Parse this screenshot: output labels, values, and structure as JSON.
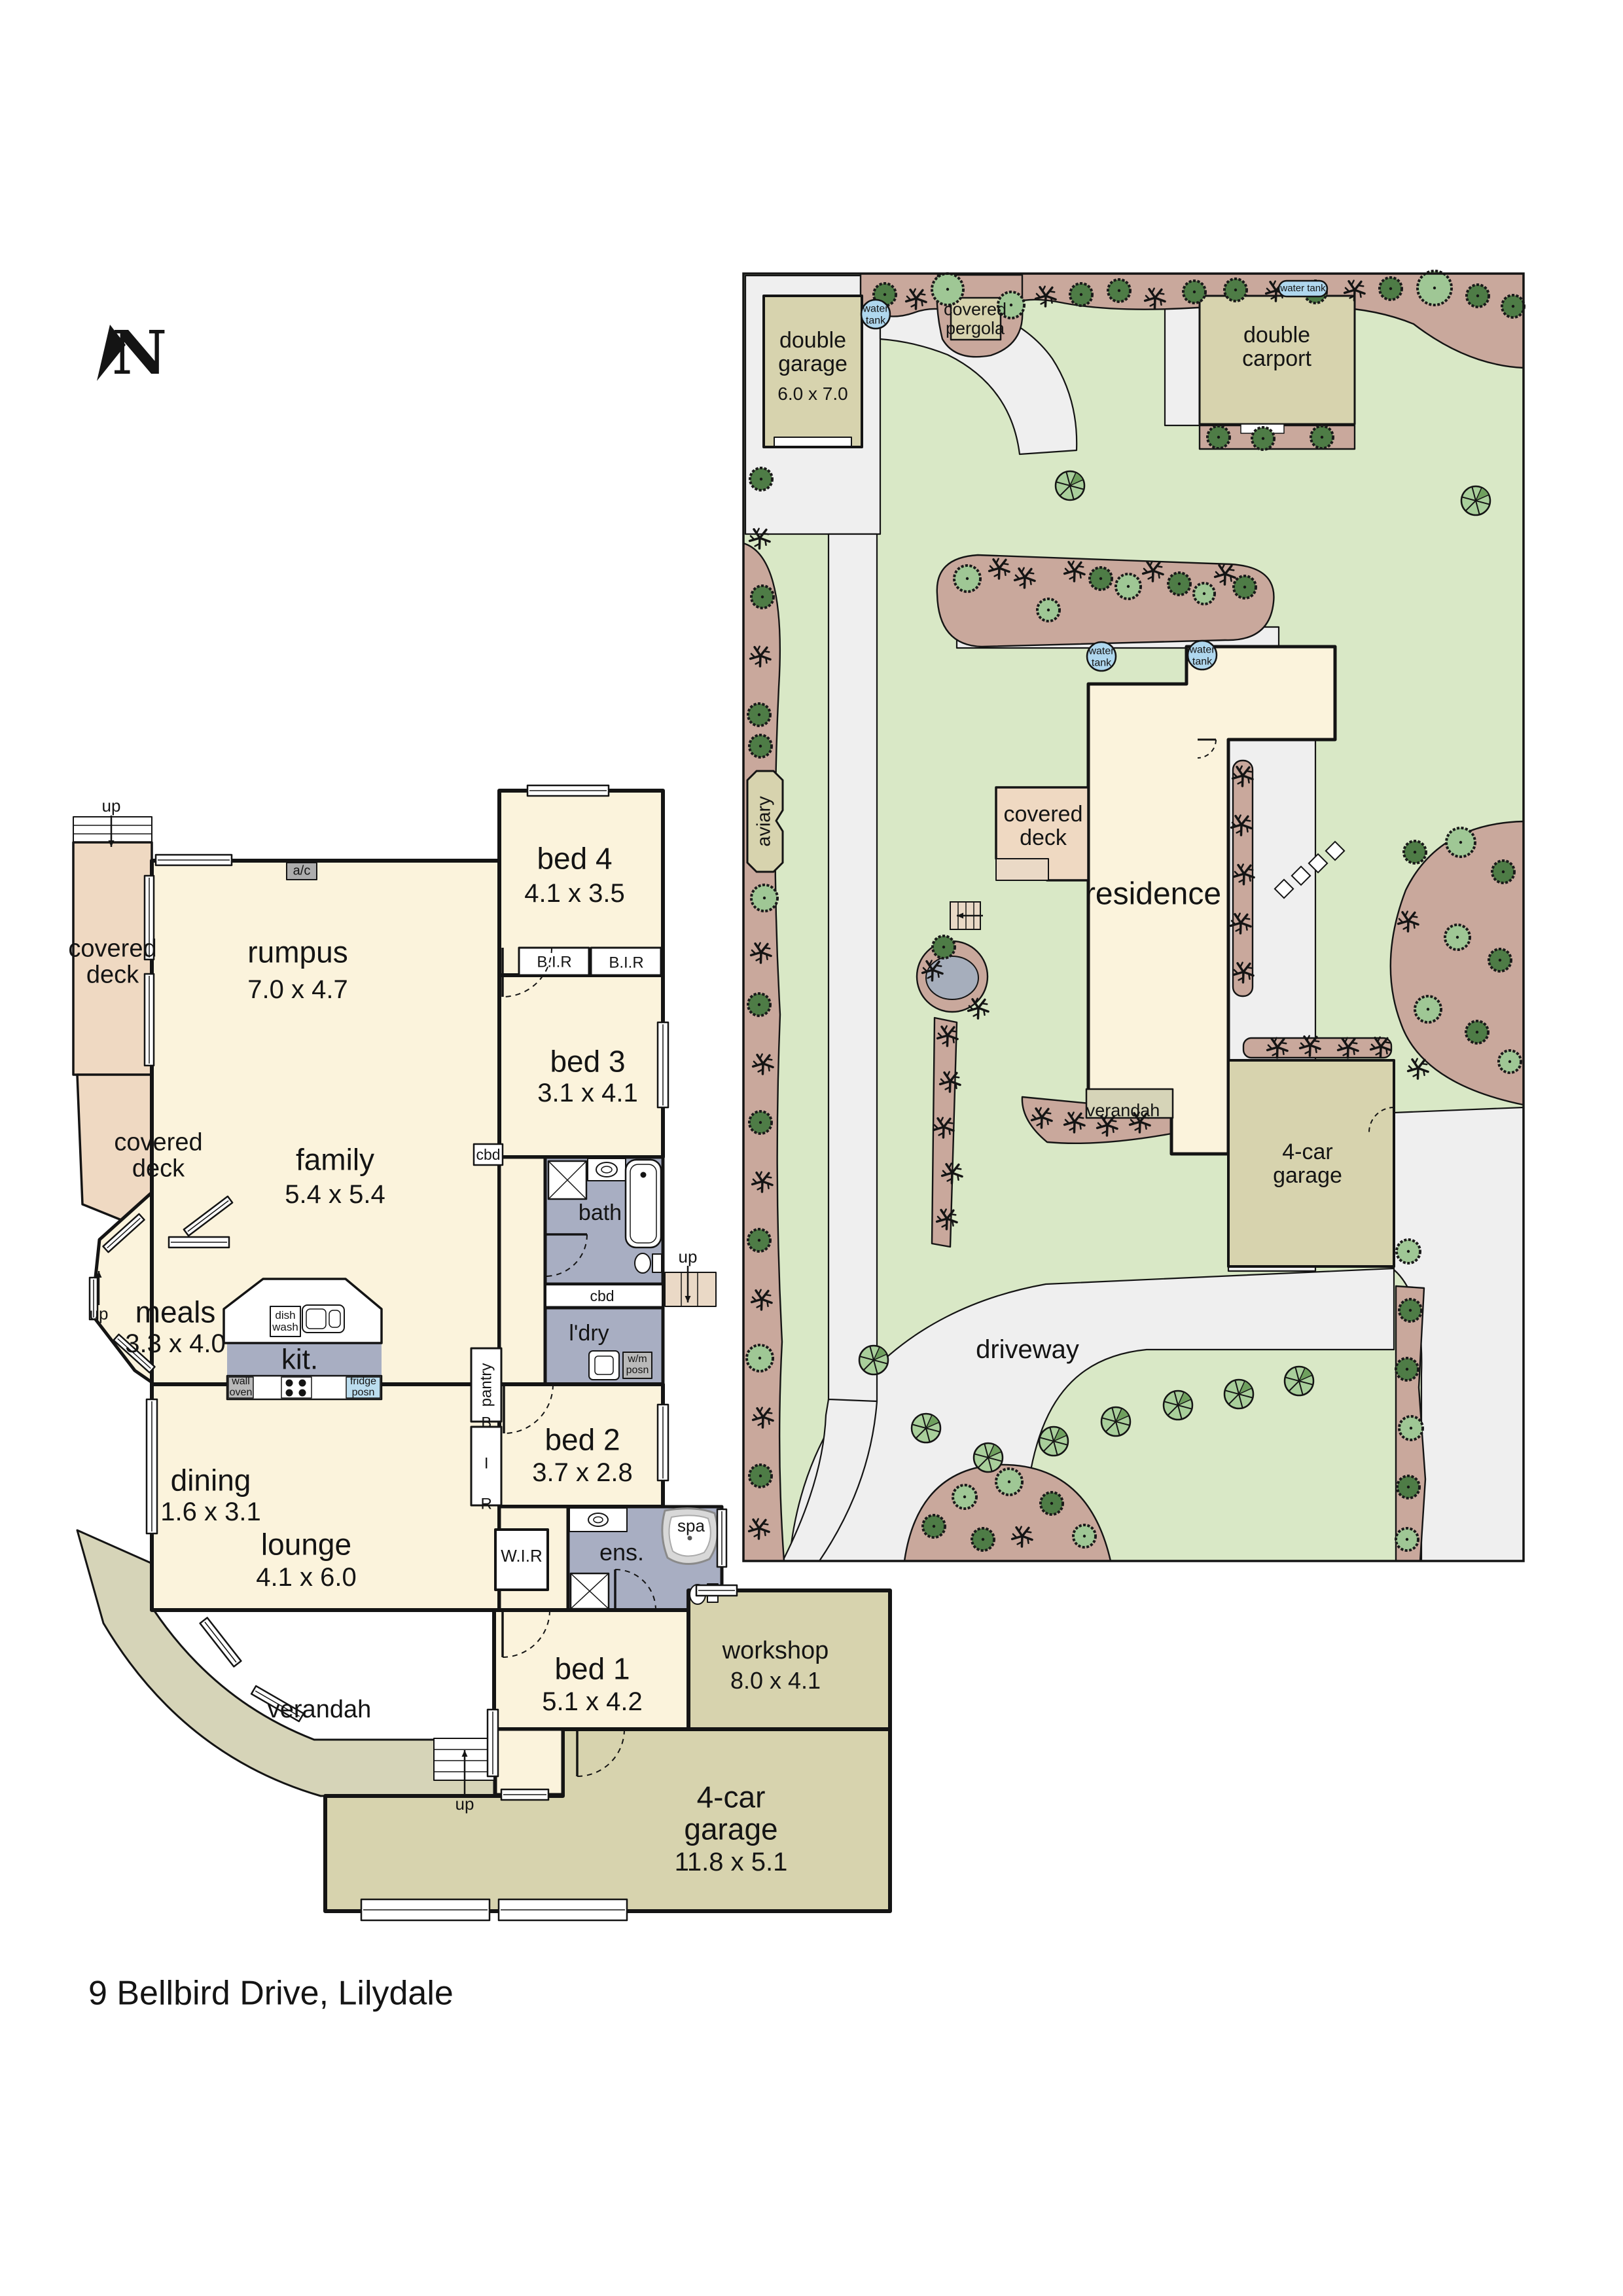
{
  "address": "9 Bellbird Drive, Lilydale",
  "compass": {
    "north_label": "N"
  },
  "fp": {
    "up": "up",
    "covered_deck": "covered deck",
    "verandah": "verandah",
    "rumpus": {
      "name": "rumpus",
      "dims": "7.0 x 4.7"
    },
    "bed4": {
      "name": "bed 4",
      "dims": "4.1 x 3.5"
    },
    "bed3": {
      "name": "bed 3",
      "dims": "3.1 x 4.1"
    },
    "bed2": {
      "name": "bed 2",
      "dims": "3.7 x 2.8"
    },
    "bed1": {
      "name": "bed 1",
      "dims": "5.1 x 4.2"
    },
    "family": {
      "name": "family",
      "dims": "5.4 x 5.4"
    },
    "meals": {
      "name": "meals",
      "dims": "3.3 x 4.0"
    },
    "dining": {
      "name": "dining",
      "dims": "1.6 x 3.1"
    },
    "lounge": {
      "name": "lounge",
      "dims": "4.1 x 6.0"
    },
    "workshop": {
      "name": "workshop",
      "dims": "8.0 x 4.1"
    },
    "garage": {
      "name": "4-car garage",
      "dims": "11.8 x 5.1"
    },
    "kit": "kit.",
    "bath": "bath",
    "ens": "ens.",
    "ldry": "l'dry",
    "wir": "W.I.R",
    "bir": "B.I.R",
    "bir_v": "B I R",
    "cbd": "cbd",
    "pantry": "pantry",
    "spa": "spa",
    "ac": "a/c",
    "dish_wash": "dish wash",
    "wall_oven": "wall oven",
    "fridge": "fridge posn",
    "wm": "w/m posn"
  },
  "site": {
    "double_garage": {
      "name": "double garage",
      "dims": "6.0 x 7.0"
    },
    "double_carport": "double carport",
    "covered_pergola": "covered pergola",
    "residence": "residence",
    "covered_deck": "covered deck",
    "verandah": "verandah",
    "garage4": {
      "name": "4-car garage"
    },
    "driveway": "driveway",
    "aviary": "aviary",
    "water_tank": "water tank",
    "water": "water",
    "tank": "tank"
  },
  "colors": {
    "lawn": "#d9e8c6",
    "garden_bed": "#c9a89c",
    "path": "#efefef",
    "room_cream": "#fbf3dc",
    "deck_salmon": "#efd9c2",
    "garage_khaki": "#d7d3ae",
    "verandah_olive": "#d6d4b8",
    "wet_area": "#a8aec2",
    "water_blue": "#afd7ee",
    "wall": "#141414"
  }
}
